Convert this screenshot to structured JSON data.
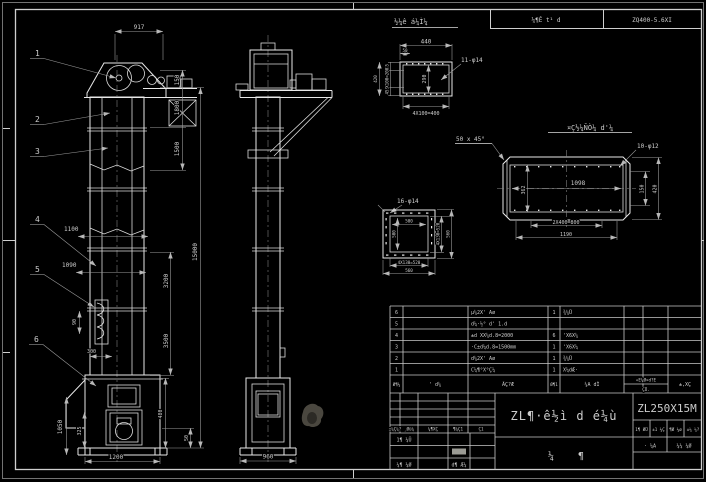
{
  "header": {
    "detail1_title": "½¼ê á¼Ì¼",
    "box1": "¼¶Ê t¹ d",
    "box2": "ZQ400-5.6XI"
  },
  "balloons": {
    "b1": "1",
    "b2": "2",
    "b3": "3",
    "b4": "4",
    "b5": "5",
    "b6": "6"
  },
  "front": {
    "dims": {
      "d917": "917",
      "d150": "150",
      "d1800": "1800",
      "d1500": "1500",
      "d15000": "15000",
      "d3200": "3200",
      "d3500": "3500",
      "d1100": "1100",
      "d1090": "1090",
      "d90": "90",
      "d300": "300",
      "d1050": "1050",
      "d325": "325",
      "d480": "480",
      "d50": "50",
      "d1200": "1200"
    }
  },
  "side": {
    "dims": {
      "d960": "960"
    }
  },
  "channel": {
    "holes": "11-φ14",
    "dims": {
      "top": "440",
      "m50": "50",
      "l45a": "45",
      "lmid": "2X100=200",
      "l45b": "45",
      "ltotal": "420",
      "height": "290",
      "bottom": "4X100=400"
    }
  },
  "flange": {
    "holes": "16-φ14",
    "dims": {
      "iw": "500",
      "ih": "500",
      "rp": "4X130=520",
      "rt": "560",
      "bp": "4X130=520",
      "bt": "560"
    }
  },
  "section": {
    "title": "¤Ç½¼ÑÒ¼ d'¼",
    "chamfer": "50 x 45°",
    "holes": "10-φ12",
    "dims": {
      "len": "1098",
      "h": "362",
      "ri": "150",
      "ro": "420",
      "pitch": "2X400=800",
      "total": "1190"
    }
  },
  "bom": {
    "headers": {
      "seq": "Ø¶¼",
      "code": "' d¼",
      "name": "ÃÇ?Æ",
      "qty": "Ø¶1",
      "material": "¼A dÌ",
      "weight1": "«E¼Ø×d?E",
      "weight2": "ÇÜ.",
      "remark": "±,XÇ"
    },
    "rows": [
      {
        "seq": "6",
        "name": "μ¼2X' Aø",
        "qty": "1",
        "material": "¾¼Ü"
      },
      {
        "seq": "5",
        "name": "d¼·½° d' 1.d",
        "qty": "",
        "material": ""
      },
      {
        "seq": "4",
        "name": "±d XX¼d.8=2000",
        "qty": "6",
        "material": "'X6X¼"
      },
      {
        "seq": "3",
        "name": "·C±d¼d.8=1500mm",
        "qty": "1",
        "material": "'X6X¼"
      },
      {
        "seq": "2",
        "name": "d¼2X' Aø",
        "qty": "1",
        "material": "¾¼Ü"
      },
      {
        "seq": "1",
        "name": "C¼¶°X°Ç¼",
        "qty": "1",
        "material": "X¼dÆ·"
      }
    ]
  },
  "title_block": {
    "drawing_title": "ZL¶·ê½ì d é¼ù",
    "model": "ZL250X15M",
    "char_l": "¼",
    "char_r": "¶",
    "rev": [
      "±¼Ç¼?",
      "¸Øü¼",
      "¼¶XÇ",
      "¶¼Ç1",
      "Ç1"
    ],
    "sign1": "1¶ ¼Ü",
    "sign2": "¼¶ ¼Ø",
    "sign3": "d¶ Æ¼",
    "stage": [
      "1¶ ØÜ",
      "±1 ¼Ç",
      "¶Ø ¼ø",
      "±¼ ¼?"
    ],
    "sheet1": "· ¼A",
    "sheet2": "¼¼ ¼Ø"
  }
}
